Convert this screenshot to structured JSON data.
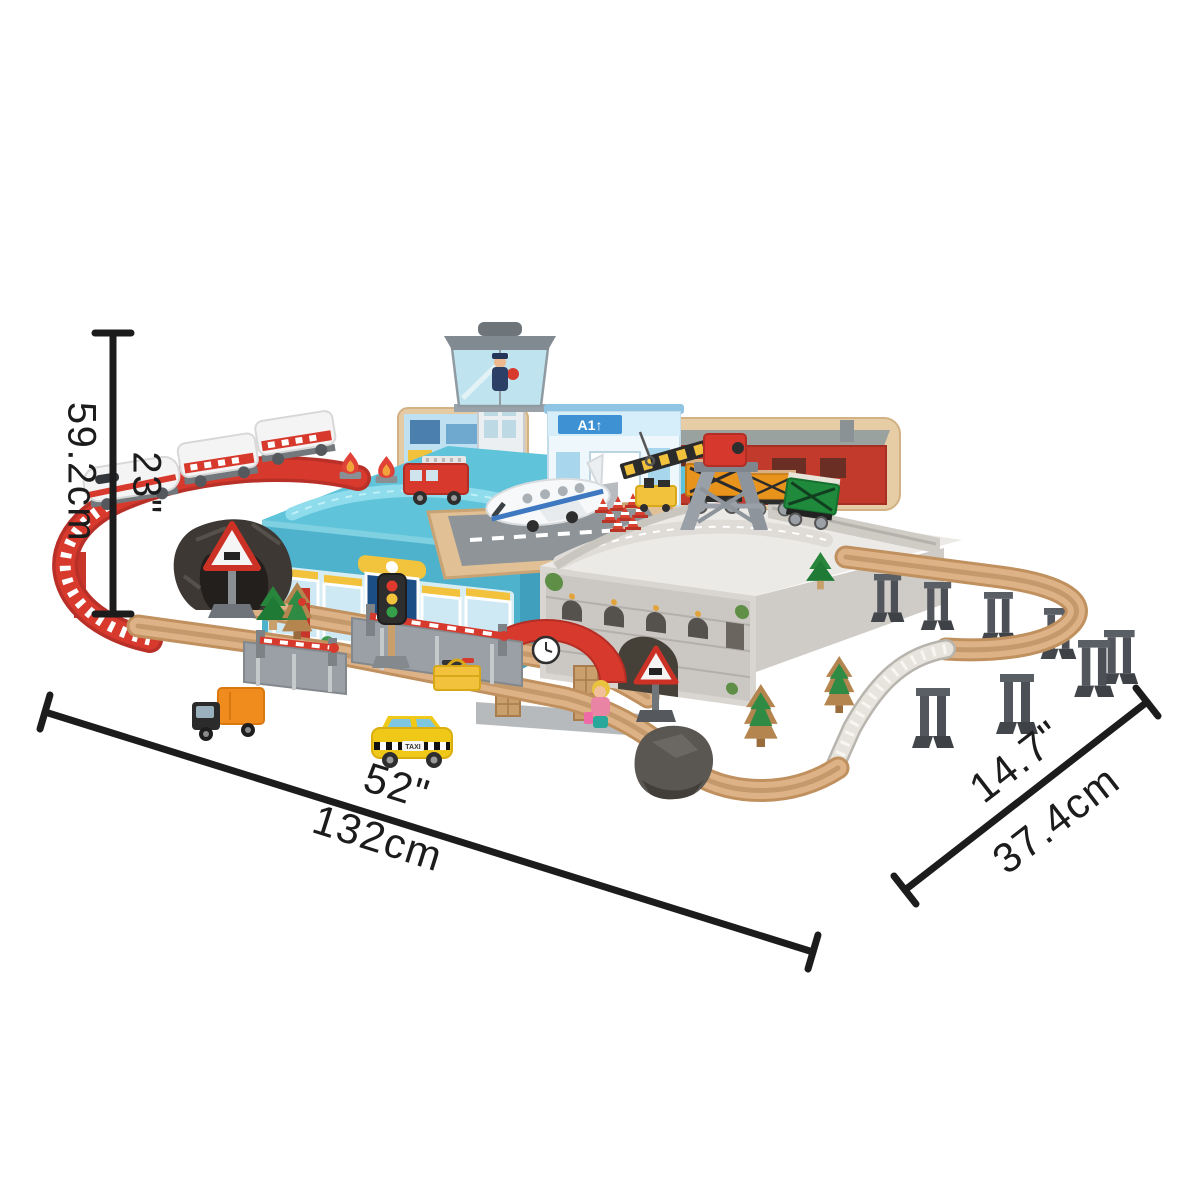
{
  "canvas": {
    "width": 1200,
    "height": 1200,
    "background": "#ffffff"
  },
  "scene": {
    "description": "Isometric product photo of a city-themed wooden train set built around two storage boxes, annotated with overall size dimensions",
    "terminal_sign": "A1↑",
    "taxi_label": "TAXI",
    "elements": [
      "white high-speed passenger train",
      "red elevated spiral track",
      "rock tunnel",
      "blue storage box with shop-front sticker",
      "air traffic control tower with controller figure",
      "airport terminal",
      "white toy airplane on runway",
      "red fire truck",
      "flame markers",
      "traffic cones",
      "yellow luggage cart",
      "grey storage box with castle bridge sticker",
      "crane with red cab",
      "orange freight wagons",
      "green freight wagon",
      "factory backdrop board",
      "elevated wooden curve on grey trestles",
      "grey girder bridge",
      "level crossings with red barriers",
      "station with red arched roof and clock",
      "girl figure",
      "triangular warning signs",
      "traffic light",
      "yellow toolbox",
      "yellow taxi",
      "orange delivery truck",
      "pine trees",
      "wooden track loop",
      "rock portal"
    ]
  },
  "dimensions": {
    "height": {
      "imperial": "23\"",
      "metric": "59.2cm"
    },
    "length": {
      "imperial": "52\"",
      "metric": "132cm"
    },
    "depth": {
      "imperial": "14.7\"",
      "metric": "37.4cm"
    }
  },
  "colors": {
    "dimension_line": "#1c1c1c",
    "box_blue": "#4fb2cd",
    "box_grey": "#d9d6d2",
    "track_wood": "#ddb287",
    "track_red": "#d7392d",
    "track_grey": "#e7e4dd",
    "crane_red": "#d6382e",
    "wagon_orange": "#e8931c",
    "wagon_green": "#1f8a3c",
    "taxi_yellow": "#f0c818",
    "truck_orange": "#f08c1e",
    "pine_green": "#1f7a36",
    "terminal_sign_blue": "#3e92d4"
  }
}
